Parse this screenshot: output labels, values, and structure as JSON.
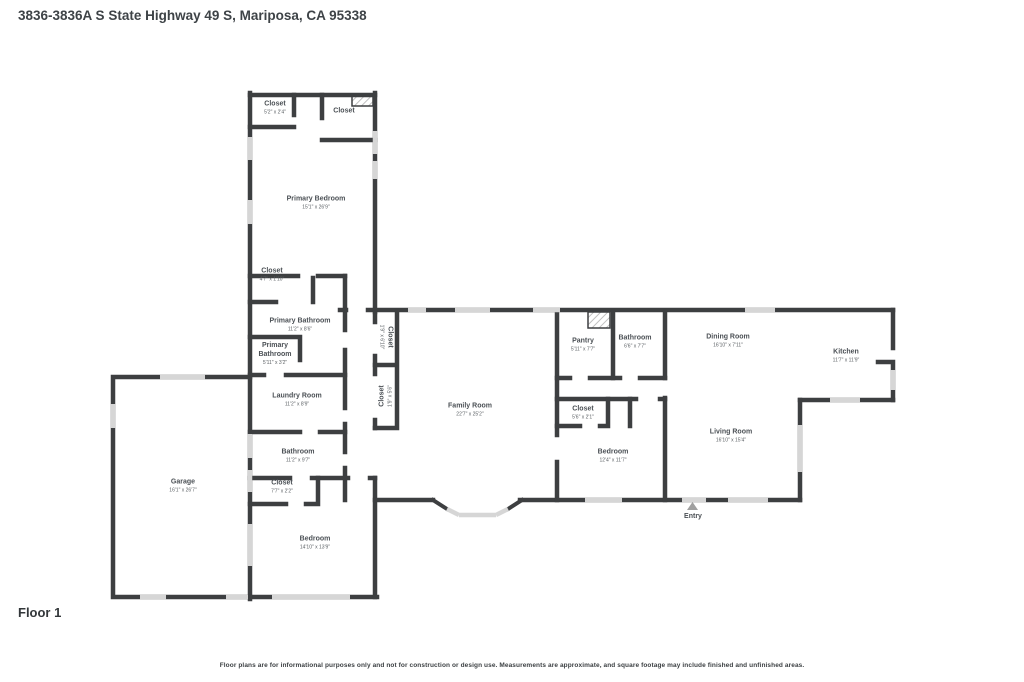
{
  "page": {
    "title": "3836-3836A S State Highway 49 S, Mariposa, CA 95338",
    "floor_label": "Floor 1",
    "disclaimer": "Floor plans are for informational purposes only and not for construction or design use. Measurements are approximate, and square footage may include finished and unfinished areas."
  },
  "colors": {
    "wall": "#3d3f41",
    "window": "#d6d6d6",
    "hatch": "#c0c0c0",
    "room_fill": "#ffffff",
    "entry_marker": "#a0a0a0",
    "title_text": "#3e4347",
    "label_text": "#4b5055"
  },
  "entry": {
    "label": "Entry",
    "marker": "triangle-up-icon"
  },
  "rooms": [
    {
      "name": "Closet",
      "dims": "5'2\" x 2'4\""
    },
    {
      "name": "Closet",
      "dims": ""
    },
    {
      "name": "Primary Bedroom",
      "dims": "15'1\" x 26'9\""
    },
    {
      "name": "Closet",
      "dims": "4'7\" x 1'10\""
    },
    {
      "name": "Primary Bathroom",
      "dims": "11'2\" x 8'6\""
    },
    {
      "name": "Primary Bathroom",
      "dims": "5'11\" x 3'2\""
    },
    {
      "name": "Closet",
      "dims": "1'9\" x 6'10\""
    },
    {
      "name": "Closet",
      "dims": "1'9\" x 5'6\""
    },
    {
      "name": "Laundry Room",
      "dims": "11'2\" x 8'9\""
    },
    {
      "name": "Bathroom",
      "dims": "11'2\" x 9'7\""
    },
    {
      "name": "Closet",
      "dims": "7'7\" x 2'2\""
    },
    {
      "name": "Bedroom",
      "dims": "14'10\" x 13'9\""
    },
    {
      "name": "Garage",
      "dims": "16'1\" x 26'7\""
    },
    {
      "name": "Family Room",
      "dims": "22'7\" x 25'2\""
    },
    {
      "name": "Pantry",
      "dims": "5'11\" x 7'7\""
    },
    {
      "name": "Bathroom",
      "dims": "6'6\" x 7'7\""
    },
    {
      "name": "Dining Room",
      "dims": "16'10\" x 7'11\""
    },
    {
      "name": "Kitchen",
      "dims": "11'7\" x 11'9\""
    },
    {
      "name": "Closet",
      "dims": "5'6\" x 2'1\""
    },
    {
      "name": "Bedroom",
      "dims": "12'4\" x 11'7\""
    },
    {
      "name": "Living Room",
      "dims": "16'10\" x 15'4\""
    }
  ]
}
